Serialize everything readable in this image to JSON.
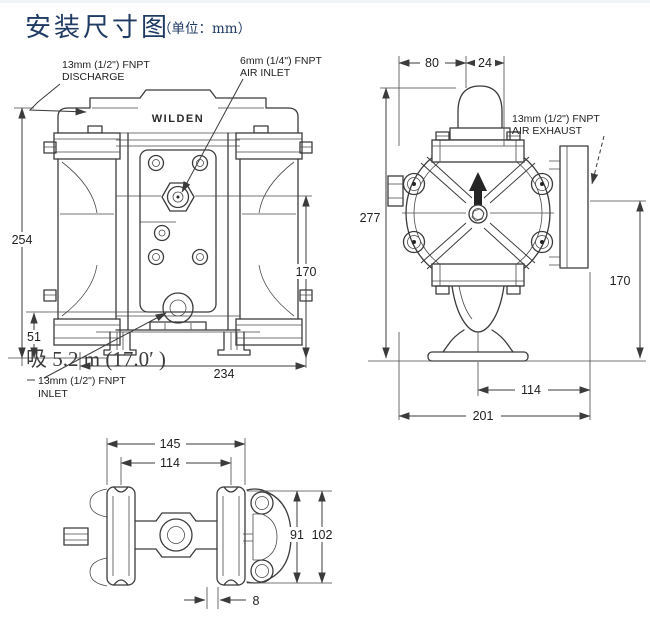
{
  "page": {
    "title": "安装尺寸图",
    "unit_note": "（单位：mm）"
  },
  "colors": {
    "title": "#1f3a63",
    "line": "#3b3b3b",
    "text": "#1f1f1f"
  },
  "front_view": {
    "brand": "WILDEN",
    "discharge_label_line1": "13mm (1/2\") FNPT",
    "discharge_label_line2": "DISCHARGE",
    "air_inlet_label_line1": "6mm (1/4\") FNPT",
    "air_inlet_label_line2": "AIR INLET",
    "inlet_label_line1": "13mm (1/2\") FNPT",
    "inlet_label_line2": "INLET",
    "suction_note": "吸  5.2 m (17.0′  )",
    "dim_overall_height": "254",
    "dim_inlet_height": "51",
    "dim_body_height": "170",
    "dim_overall_width": "234"
  },
  "side_view": {
    "air_exhaust_label_line1": "13mm (1/2\") FNPT",
    "air_exhaust_label_line2": "AIR EXHAUST",
    "dim_top_flange_offset": "80",
    "dim_pipe_width": "24",
    "dim_overall_height": "277",
    "dim_exhaust_height": "170",
    "dim_foot_to_muffler": "114",
    "dim_overall_width": "201"
  },
  "bottom_view": {
    "dim_foot_outer_width": "145",
    "dim_foot_center_spacing": "114",
    "dim_flange_height": "91",
    "dim_overall_depth": "102",
    "dim_foot_thickness": "8"
  }
}
